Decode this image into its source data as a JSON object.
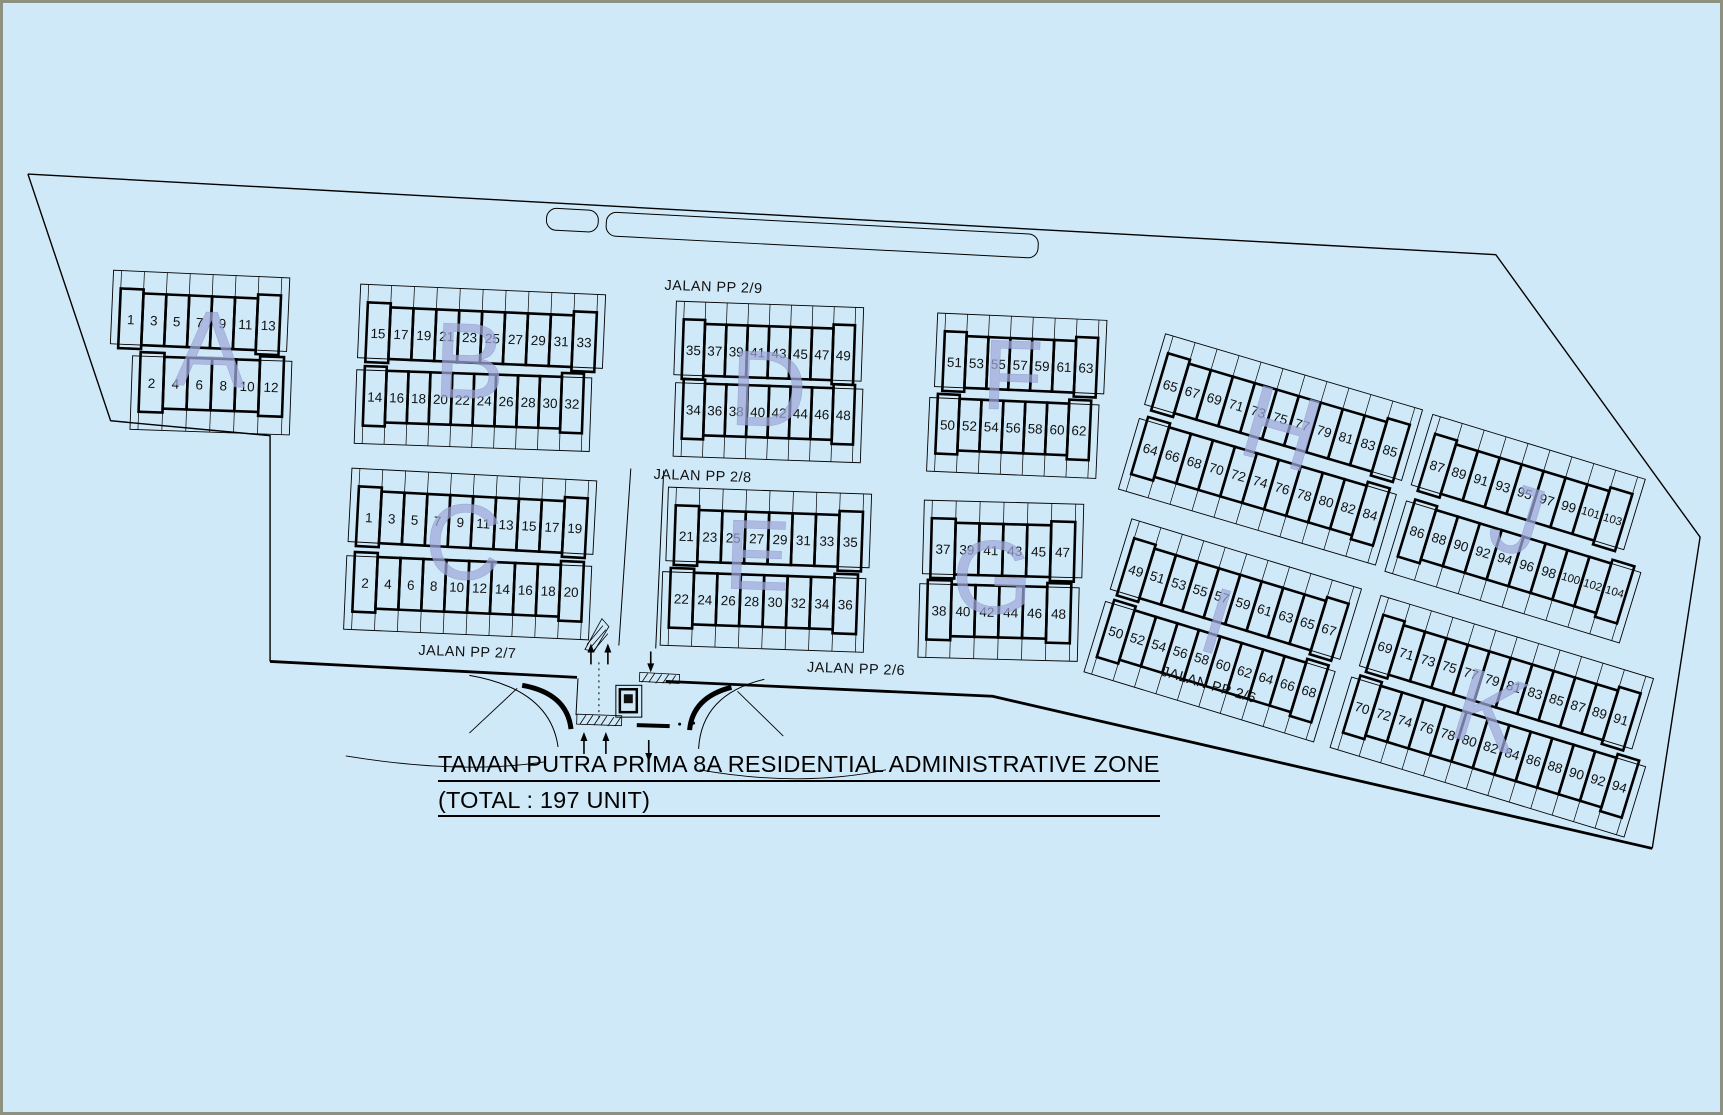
{
  "page": {
    "background": "#cfe9f8",
    "frame_color": "#8f9180",
    "line_color": "#000000",
    "letter_color": "#9fa9d9",
    "text_color": "#111111"
  },
  "title": {
    "line1": "TAMAN PUTRA PRIMA 8A RESIDENTIAL ADMINISTRATIVE ZONE",
    "line2": "(TOTAL : 197 UNIT)"
  },
  "streets": [
    {
      "name": "JALAN PP 2/9",
      "x": 713,
      "y": 286,
      "angle": 2
    },
    {
      "name": "JALAN PP 2/8",
      "x": 702,
      "y": 476,
      "angle": 2
    },
    {
      "name": "JALAN PP 2/7",
      "x": 466,
      "y": 653,
      "angle": 2
    },
    {
      "name": "JALAN PP 2/6",
      "x": 856,
      "y": 670,
      "angle": 2
    },
    {
      "name": "JALAN PP 2/6",
      "x": 1210,
      "y": 686,
      "angle": 16.5
    }
  ],
  "boundary": {
    "thin": [
      [
        [
          25,
          172
        ],
        [
          1498,
          253
        ],
        [
          1703,
          537
        ],
        [
          1655,
          850
        ]
      ],
      [
        [
          268,
          662
        ],
        [
          268,
          435
        ],
        [
          108,
          420
        ],
        [
          25,
          172
        ]
      ]
    ],
    "thick": [
      [
        [
          1655,
          850
        ],
        [
          993,
          697
        ],
        [
          665,
          682
        ]
      ],
      [
        [
          576,
          678
        ],
        [
          268,
          662
        ]
      ]
    ]
  },
  "roads": {
    "medians": [
      {
        "x": 546,
        "y": 206,
        "w": 52,
        "h": 22,
        "angle": 3
      },
      {
        "x": 606,
        "y": 210,
        "w": 434,
        "h": 24,
        "angle": 3
      }
    ],
    "lines": [
      {
        "x1": 618,
        "y1": 646,
        "x2": 630,
        "y2": 468
      },
      {
        "x1": 655,
        "y1": 649,
        "x2": 663,
        "y2": 470
      }
    ]
  },
  "blocks": [
    {
      "letter": "A",
      "lx": 208,
      "ly": 348,
      "lsize": 108,
      "langle": 2,
      "rows": [
        {
          "x": 118,
          "y": 291,
          "angle": 2.5,
          "w": 23,
          "tick": -1,
          "units": [
            "1",
            "3",
            "5",
            "7",
            "9",
            "11",
            "13"
          ]
        },
        {
          "x": 138,
          "y": 355,
          "angle": 2,
          "w": 24,
          "tick": 1,
          "units": [
            "2",
            "4",
            "6",
            "8",
            "10",
            "12"
          ]
        }
      ]
    },
    {
      "letter": "B",
      "lx": 468,
      "ly": 360,
      "lsize": 108,
      "langle": 2,
      "rows": [
        {
          "x": 366,
          "y": 305,
          "angle": 2.5,
          "w": 23,
          "tick": -1,
          "units": [
            "15",
            "17",
            "19",
            "21",
            "23",
            "25",
            "27",
            "29",
            "31",
            "33"
          ]
        },
        {
          "x": 363,
          "y": 369,
          "angle": 2,
          "w": 22,
          "tick": 1,
          "units": [
            "14",
            "16",
            "18",
            "20",
            "22",
            "24",
            "26",
            "28",
            "30",
            "32"
          ]
        }
      ]
    },
    {
      "letter": "D",
      "lx": 768,
      "ly": 388,
      "lsize": 108,
      "langle": 2,
      "rows": [
        {
          "x": 683,
          "y": 322,
          "angle": 2,
          "w": 21.5,
          "tick": -1,
          "units": [
            "35",
            "37",
            "39",
            "41",
            "43",
            "45",
            "47",
            "49"
          ]
        },
        {
          "x": 683,
          "y": 382,
          "angle": 2,
          "w": 21.5,
          "tick": 1,
          "units": [
            "34",
            "36",
            "38",
            "40",
            "42",
            "44",
            "46",
            "48"
          ]
        }
      ]
    },
    {
      "letter": "F",
      "lx": 1013,
      "ly": 375,
      "lsize": 100,
      "langle": 2,
      "rows": [
        {
          "x": 945,
          "y": 334,
          "angle": 2.5,
          "w": 22,
          "tick": -1,
          "units": [
            "51",
            "53",
            "55",
            "57",
            "59",
            "61",
            "63"
          ]
        },
        {
          "x": 938,
          "y": 397,
          "angle": 2.5,
          "w": 22,
          "tick": 1,
          "units": [
            "50",
            "52",
            "54",
            "56",
            "58",
            "60",
            "62"
          ]
        }
      ]
    },
    {
      "letter": "H",
      "lx": 1283,
      "ly": 428,
      "lsize": 105,
      "langle": 16,
      "rows": [
        {
          "x": 1168,
          "y": 356,
          "angle": 16.5,
          "w": 23,
          "tick": -1,
          "units": [
            "65",
            "67",
            "69",
            "71",
            "73",
            "75",
            "77",
            "79",
            "81",
            "83",
            "85"
          ]
        },
        {
          "x": 1148,
          "y": 420,
          "angle": 16.5,
          "w": 23,
          "tick": 1,
          "units": [
            "64",
            "66",
            "68",
            "70",
            "72",
            "74",
            "76",
            "78",
            "80",
            "82",
            "84"
          ]
        }
      ]
    },
    {
      "letter": "J",
      "lx": 1520,
      "ly": 520,
      "lsize": 100,
      "langle": 17,
      "rows": [
        {
          "x": 1436,
          "y": 437,
          "angle": 17,
          "w": 23,
          "tick": -1,
          "units": [
            "87",
            "89",
            "91",
            "93",
            "95",
            "97",
            "99",
            "101",
            "103"
          ]
        },
        {
          "x": 1416,
          "y": 503,
          "angle": 17,
          "w": 23,
          "tick": 1,
          "units": [
            "86",
            "88",
            "90",
            "92",
            "94",
            "96",
            "98",
            "100",
            "102",
            "104"
          ]
        }
      ]
    },
    {
      "letter": "C",
      "lx": 462,
      "ly": 542,
      "lsize": 108,
      "langle": 2,
      "rows": [
        {
          "x": 357,
          "y": 490,
          "angle": 3,
          "w": 23,
          "tick": -1,
          "units": [
            "1",
            "3",
            "5",
            "7",
            "9",
            "11",
            "13",
            "15",
            "17",
            "19"
          ]
        },
        {
          "x": 353,
          "y": 556,
          "angle": 2.5,
          "w": 23,
          "tick": 1,
          "units": [
            "2",
            "4",
            "6",
            "8",
            "10",
            "12",
            "14",
            "16",
            "18",
            "20"
          ]
        }
      ]
    },
    {
      "letter": "E",
      "lx": 757,
      "ly": 556,
      "lsize": 100,
      "langle": 2,
      "rows": [
        {
          "x": 675,
          "y": 509,
          "angle": 2,
          "w": 23.5,
          "tick": -1,
          "units": [
            "21",
            "23",
            "25",
            "27",
            "29",
            "31",
            "33",
            "35"
          ]
        },
        {
          "x": 670,
          "y": 572,
          "angle": 2,
          "w": 23.5,
          "tick": 1,
          "units": [
            "22",
            "24",
            "26",
            "28",
            "30",
            "32",
            "34",
            "36"
          ]
        }
      ]
    },
    {
      "letter": "G",
      "lx": 993,
      "ly": 578,
      "lsize": 105,
      "langle": 2,
      "rows": [
        {
          "x": 932,
          "y": 522,
          "angle": 1.5,
          "w": 24,
          "tick": -1,
          "units": [
            "37",
            "39",
            "41",
            "43",
            "45",
            "47"
          ]
        },
        {
          "x": 928,
          "y": 584,
          "angle": 1.5,
          "w": 24,
          "tick": 1,
          "units": [
            "38",
            "40",
            "42",
            "44",
            "46",
            "48"
          ]
        }
      ]
    },
    {
      "letter": "I",
      "lx": 1218,
      "ly": 622,
      "lsize": 95,
      "langle": 17,
      "rows": [
        {
          "x": 1134,
          "y": 542,
          "angle": 17,
          "w": 22.5,
          "tick": -1,
          "units": [
            "49",
            "51",
            "53",
            "55",
            "57",
            "59",
            "61",
            "63",
            "65",
            "67"
          ]
        },
        {
          "x": 1114,
          "y": 604,
          "angle": 17,
          "w": 22.5,
          "tick": 1,
          "units": [
            "50",
            "52",
            "54",
            "56",
            "58",
            "60",
            "62",
            "64",
            "66",
            "68"
          ]
        }
      ]
    },
    {
      "letter": "K",
      "lx": 1492,
      "ly": 712,
      "lsize": 105,
      "langle": 17,
      "rows": [
        {
          "x": 1384,
          "y": 619,
          "angle": 17,
          "w": 22.5,
          "tick": -1,
          "units": [
            "69",
            "71",
            "73",
            "75",
            "77",
            "79",
            "81",
            "83",
            "85",
            "87",
            "89",
            "91"
          ]
        },
        {
          "x": 1361,
          "y": 680,
          "angle": 17,
          "w": 22.5,
          "tick": 1,
          "units": [
            "70",
            "72",
            "74",
            "76",
            "78",
            "80",
            "82",
            "84",
            "86",
            "88",
            "90",
            "92",
            "94"
          ]
        }
      ]
    }
  ]
}
